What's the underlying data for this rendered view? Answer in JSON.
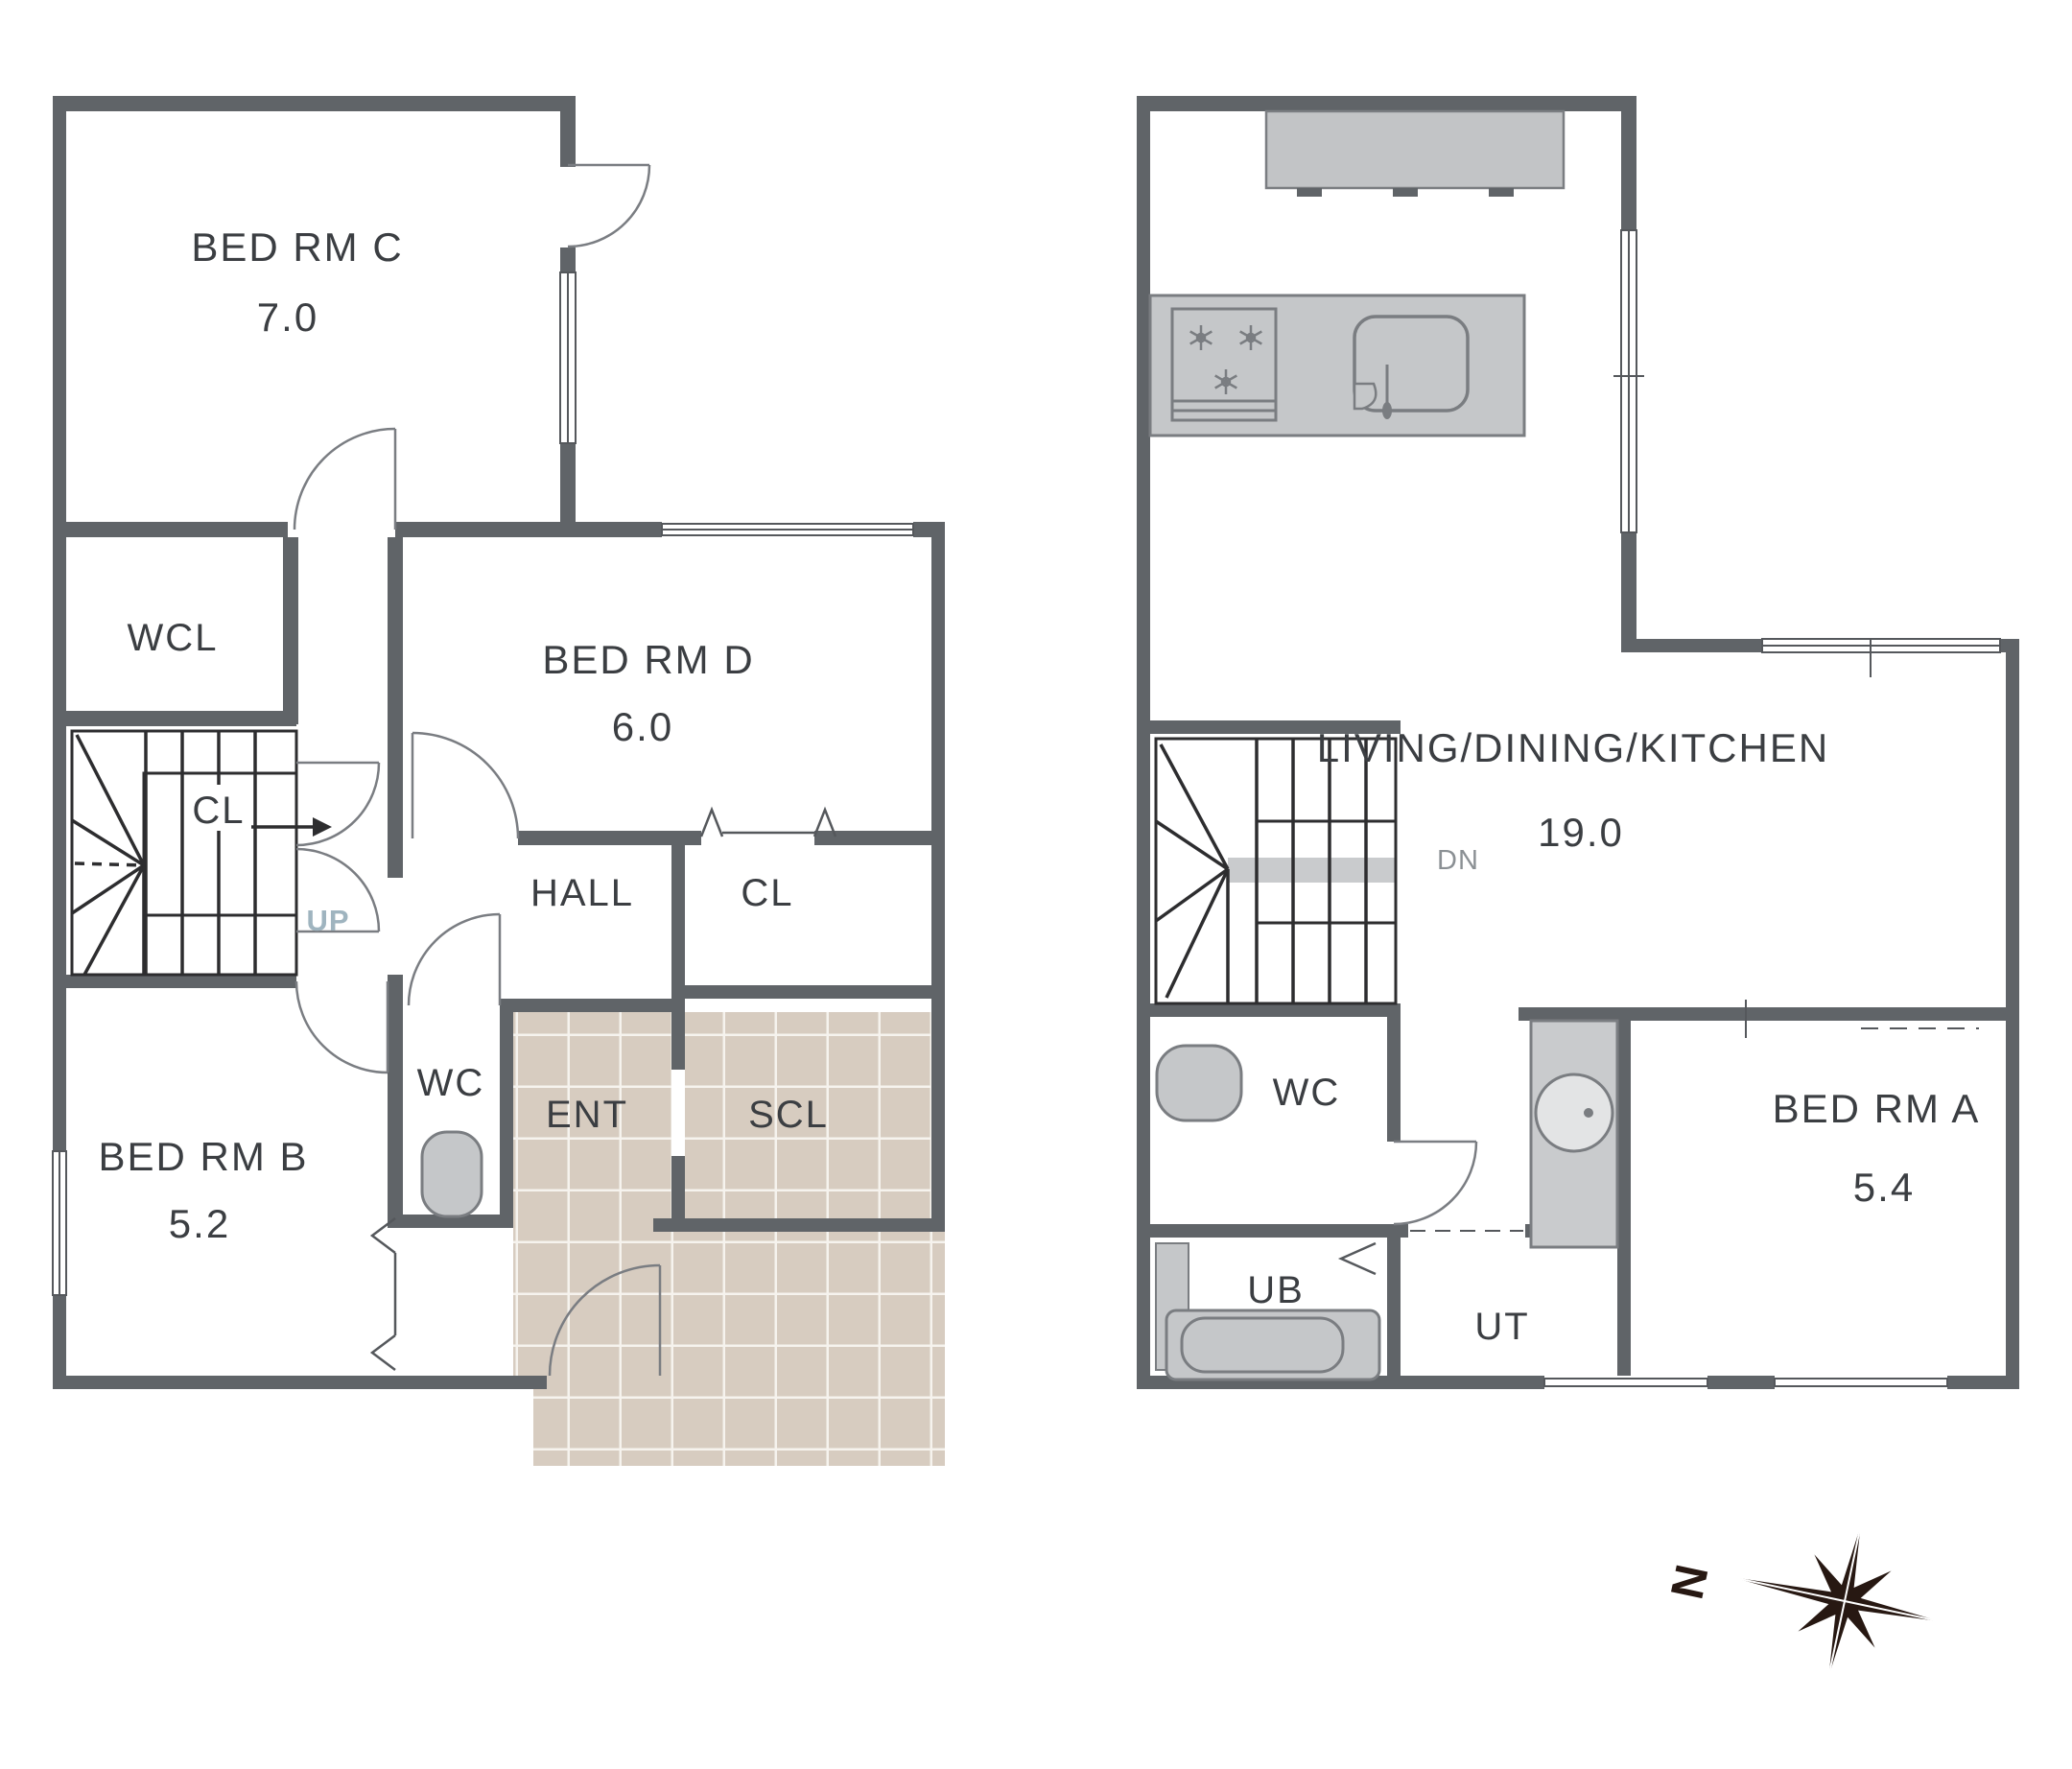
{
  "first_floor": {
    "rooms": {
      "bed_rm_c": {
        "label": "BED RM C",
        "area": "7.0"
      },
      "wcl": {
        "label": "WCL"
      },
      "stair_closet": {
        "label": "CL"
      },
      "up": {
        "label": "UP"
      },
      "bed_rm_d": {
        "label": "BED RM D",
        "area": "6.0"
      },
      "hall": {
        "label": "HALL"
      },
      "closet": {
        "label": "CL"
      },
      "wc": {
        "label": "WC"
      },
      "ent": {
        "label": "ENT"
      },
      "scl": {
        "label": "SCL"
      },
      "bed_rm_b": {
        "label": "BED RM B",
        "area": "5.2"
      }
    }
  },
  "second_floor": {
    "rooms": {
      "ldk": {
        "label": "LIVING/DINING/KITCHEN",
        "area": "19.0"
      },
      "dn": {
        "label": "DN"
      },
      "wc": {
        "label": "WC"
      },
      "ub": {
        "label": "UB"
      },
      "ut": {
        "label": "UT"
      },
      "bed_rm_a": {
        "label": "BED RM A",
        "area": "5.4"
      }
    }
  },
  "compass": {
    "north": "N"
  },
  "colors": {
    "wall": "#606468",
    "tile": "#d7ccc0",
    "tile_grout": "#f6f3ee",
    "fixture": "#c5c7c9",
    "text": "#3b3e42",
    "up_label": "#9fb4bf",
    "dn_label": "#8b9094",
    "compass": "#271812"
  }
}
